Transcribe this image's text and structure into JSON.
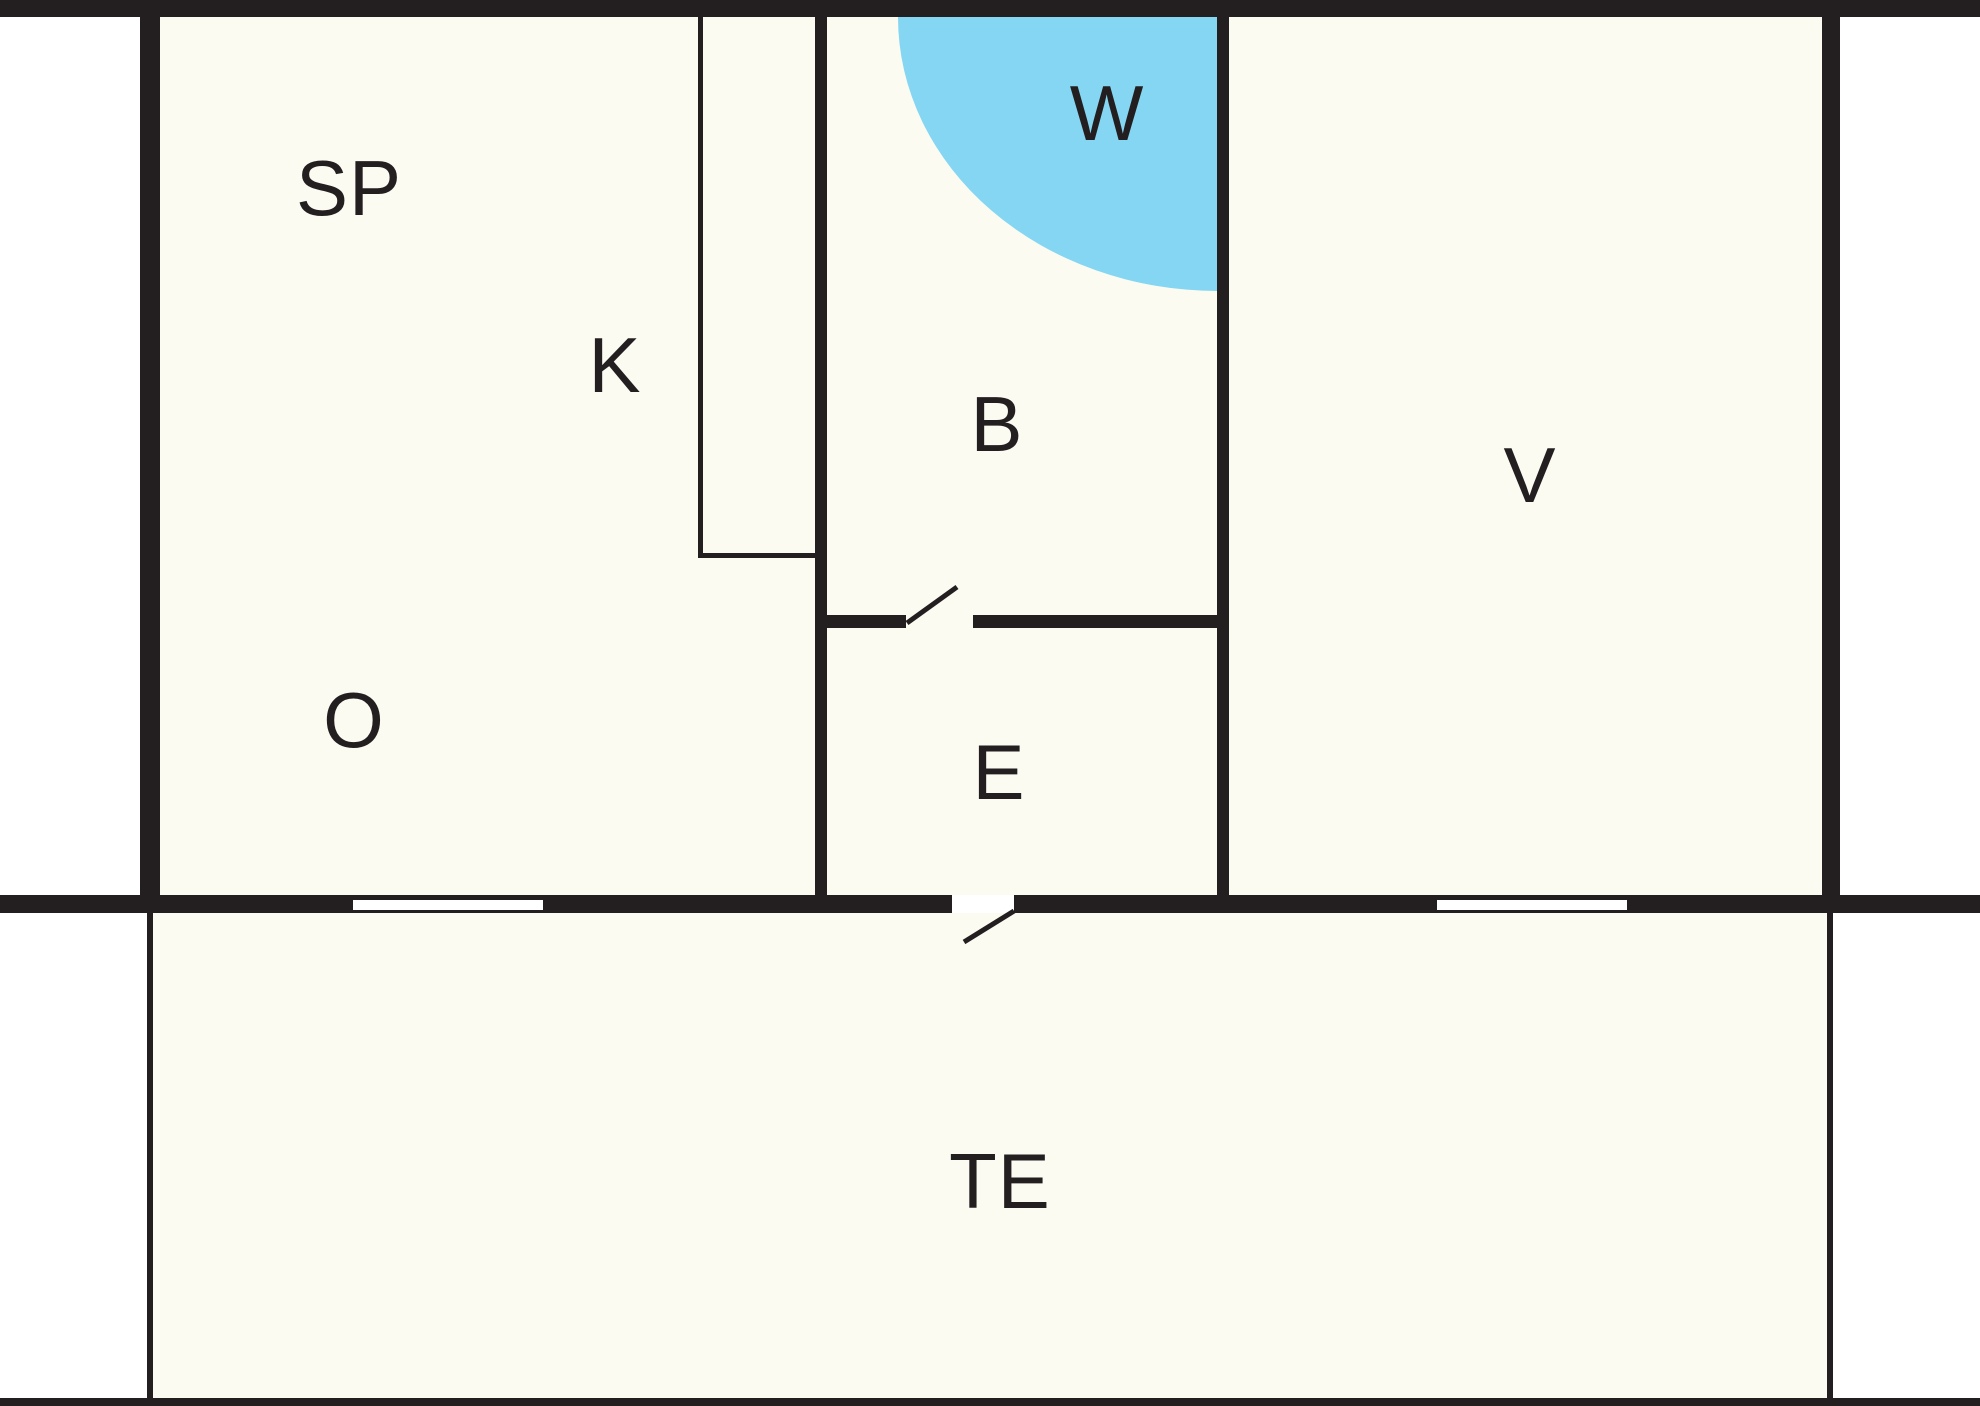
{
  "diagram": {
    "kind": "floor-plan",
    "room_labels": [
      {
        "id": "sp",
        "label": "SP"
      },
      {
        "id": "k",
        "label": "K"
      },
      {
        "id": "w",
        "label": "W"
      },
      {
        "id": "b",
        "label": "B"
      },
      {
        "id": "e",
        "label": "E"
      },
      {
        "id": "v",
        "label": "V"
      },
      {
        "id": "o",
        "label": "O"
      },
      {
        "id": "te",
        "label": "TE"
      }
    ],
    "colors": {
      "wall": "#231f20",
      "floor": "#fbfbf2",
      "outside": "#ffffff",
      "wet_area": "#84d6f2",
      "label": "#231f20"
    }
  }
}
